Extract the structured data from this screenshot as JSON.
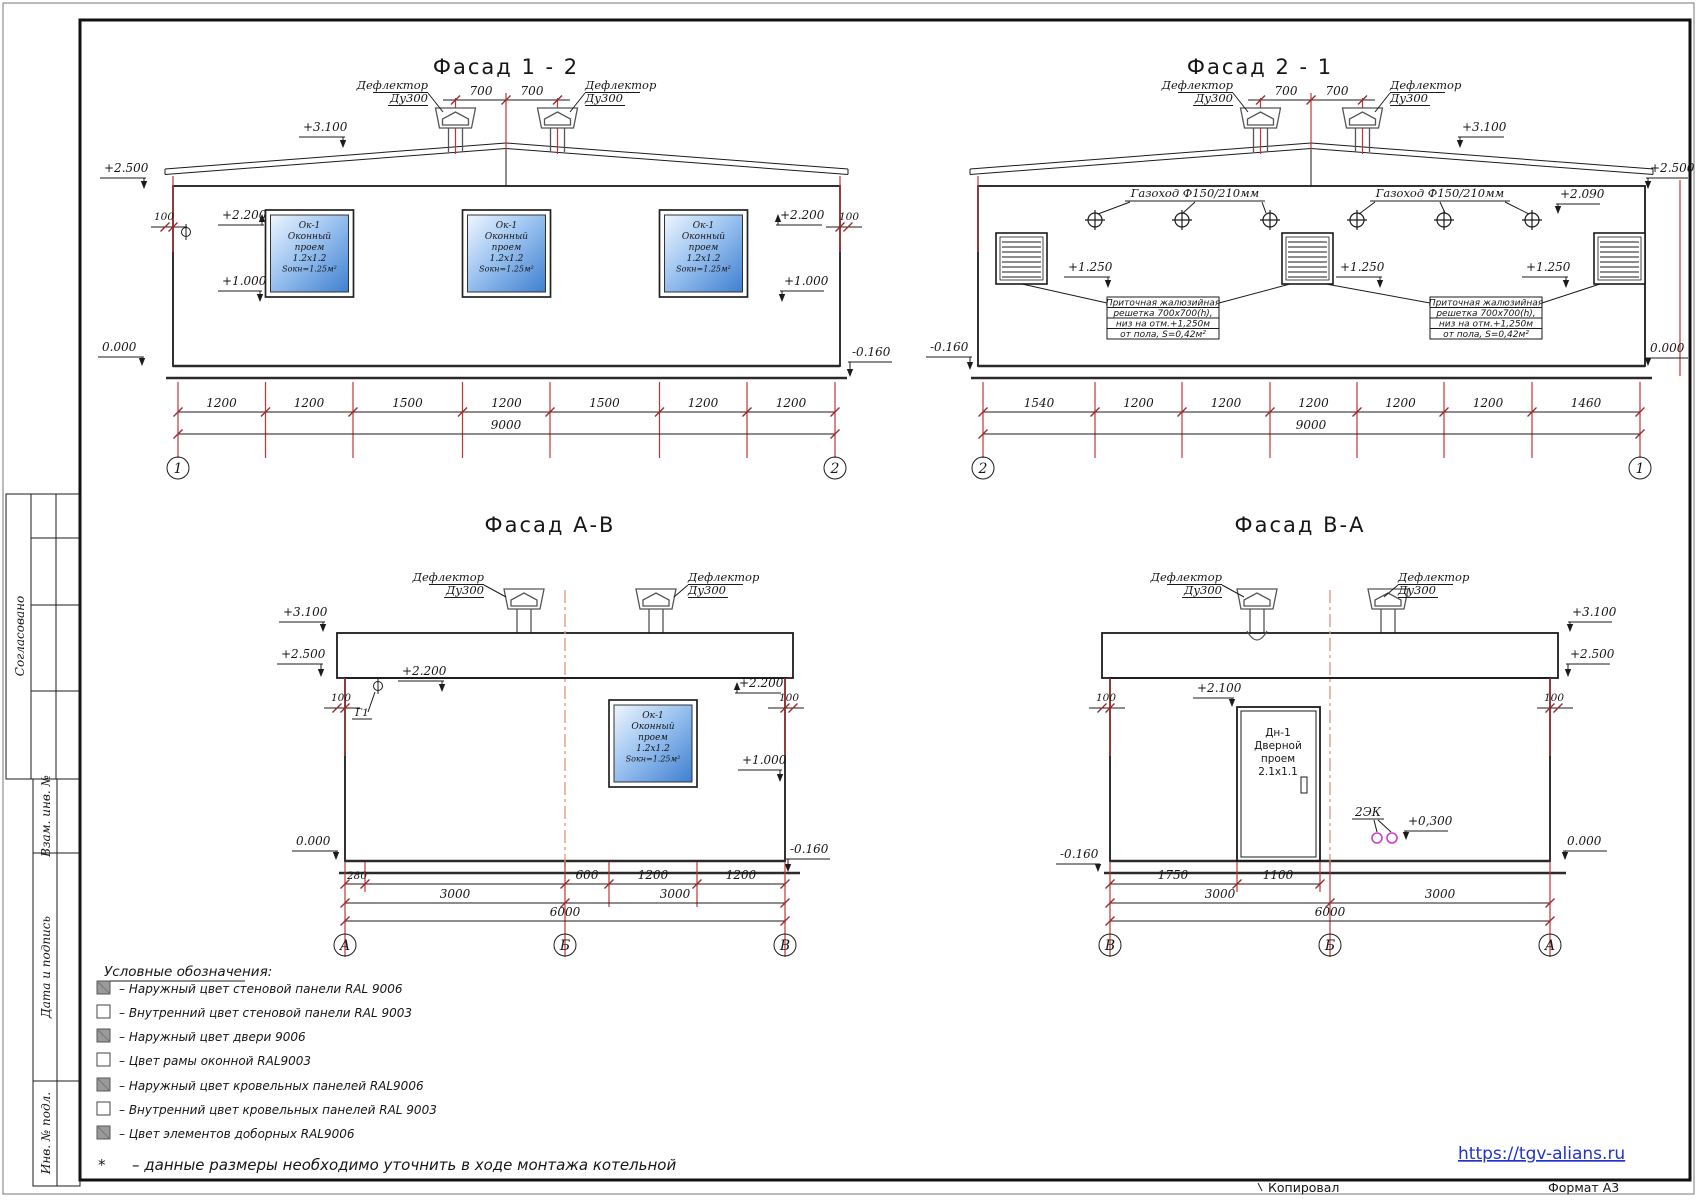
{
  "page": {
    "url": "https://tgv-alians.ru",
    "copied_label": "Копировал",
    "format_label": "Формат А3"
  },
  "sidebar": {
    "agreed": "Согласовано",
    "stamp_rows": [
      "Взам. инв. №",
      "Дата и подпись",
      "Инв. № подл."
    ]
  },
  "legend": {
    "title": "Условные обозначения:",
    "items": [
      {
        "swatch": "gray",
        "label": "– Наружный цвет стеновой панели RAL 9006"
      },
      {
        "swatch": "white",
        "label": "– Внутренний цвет стеновой панели RAL 9003"
      },
      {
        "swatch": "gray",
        "label": "– Наружный цвет двери 9006"
      },
      {
        "swatch": "white",
        "label": "– Цвет рамы оконной RAL9003"
      },
      {
        "swatch": "gray",
        "label": "– Наружный цвет кровельных панелей RAL9006"
      },
      {
        "swatch": "white",
        "label": "– Внутренний цвет кровельных панелей RAL 9003"
      },
      {
        "swatch": "gray",
        "label": "– Цвет элементов доборных RAL9006"
      }
    ],
    "footnote_star": "*",
    "footnote": "– данные размеры необходимо уточнить в ходе монтажа котельной"
  },
  "common": {
    "deflector": "Дефлектор",
    "du300": "Ду300",
    "d700": "700",
    "window_lines": [
      "Ок-1",
      "Оконный",
      "проем",
      "1.2х1.2",
      "Sокн=1.25м²"
    ],
    "elev": {
      "p3100": "+3.100",
      "p2500": "+2.500",
      "p2200": "+2.200",
      "p2100": "+2.100",
      "p2090": "+2.090",
      "p1250": "+1.250",
      "p1000": "+1.000",
      "p0300": "+0,300",
      "zero": "0.000",
      "m0160": "-0.160",
      "n100": "100"
    }
  },
  "f12": {
    "title": "Фасад 1 - 2",
    "dims": [
      "1200",
      "1200",
      "1500",
      "1200",
      "1500",
      "1200",
      "1200"
    ],
    "total": "9000",
    "axes": [
      "1",
      "2"
    ]
  },
  "f21": {
    "title": "Фасад 2 - 1",
    "gazohod": "Газоход Ф150/210мм",
    "note": [
      "Приточная жалюзийная",
      "решетка 700х700(h),",
      "низ на отм.+1,250м",
      "от пола, S=0,42м²"
    ],
    "dims": [
      "1540",
      "1200",
      "1200",
      "1200",
      "1200",
      "1200",
      "1460"
    ],
    "total": "9000",
    "axes": [
      "2",
      "1"
    ]
  },
  "fab": {
    "title": "Фасад А-В",
    "g1": "Г1",
    "dims1": [
      "280",
      "600",
      "1200",
      "1200"
    ],
    "dims2": [
      "3000",
      "3000"
    ],
    "total": "6000",
    "axes": [
      "А",
      "Б",
      "В"
    ]
  },
  "fba": {
    "title": "Фасад В-А",
    "ek": "2ЭК",
    "door_lines": [
      "Дн-1",
      "Дверной",
      "проем",
      "2.1х1.1"
    ],
    "dims1": [
      "1750",
      "1100"
    ],
    "dims2": [
      "3000",
      "3000"
    ],
    "total": "6000",
    "axes": [
      "В",
      "Б",
      "А"
    ]
  }
}
